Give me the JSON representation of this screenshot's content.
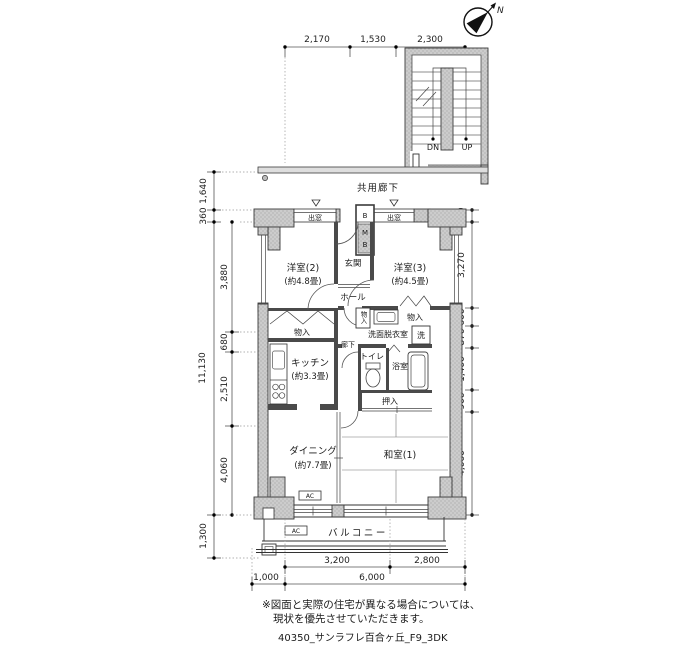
{
  "compass": {
    "north": "N"
  },
  "stairwell": {
    "down": "DN",
    "up": "UP"
  },
  "shared_corridor": "共用廊下",
  "labels": {
    "demado": "出窓",
    "monoire": "物入",
    "sen": "洗",
    "rouka": "廊下",
    "toilet": "トイレ",
    "bath": "浴室",
    "oshiire": "押入",
    "genkan": "玄関",
    "hall": "ホール",
    "senmen": "洗面脱衣室",
    "balcony": "バルコニー",
    "washitsu": "和室(1)",
    "ac": "AC",
    "mb": [
      "B",
      "M",
      "B"
    ]
  },
  "rooms": {
    "western2": {
      "name": "洋室(2)",
      "area": "(約4.8畳)"
    },
    "western3": {
      "name": "洋室(3)",
      "area": "(約4.5畳)"
    },
    "kitchen": {
      "name": "キッチン",
      "area": "(約3.3畳)"
    },
    "dining": {
      "name": "ダイニング",
      "area": "(約7.7畳)"
    }
  },
  "dimensions": {
    "top": [
      "2,170",
      "1,530",
      "2,300"
    ],
    "left_outer": [
      "1,640",
      "360",
      "11,130",
      "1,300"
    ],
    "left_inner": [
      "3,880",
      "680",
      "2,510",
      "4,060"
    ],
    "right": [
      "360",
      "3,270",
      "600",
      "870",
      "1,400",
      "900",
      "4,060"
    ],
    "bottom_row1": [
      "3,200",
      "2,800"
    ],
    "bottom_row2": [
      "1,000",
      "6,000"
    ]
  },
  "notes": {
    "line1": "※図面と実際の住宅が異なる場合については、",
    "line2": "現状を優先させていただきます。"
  },
  "footer": "40350_サンラフレ百合ヶ丘_F9_3DK",
  "colors": {
    "wall": "#cccccc",
    "line": "#333333"
  }
}
